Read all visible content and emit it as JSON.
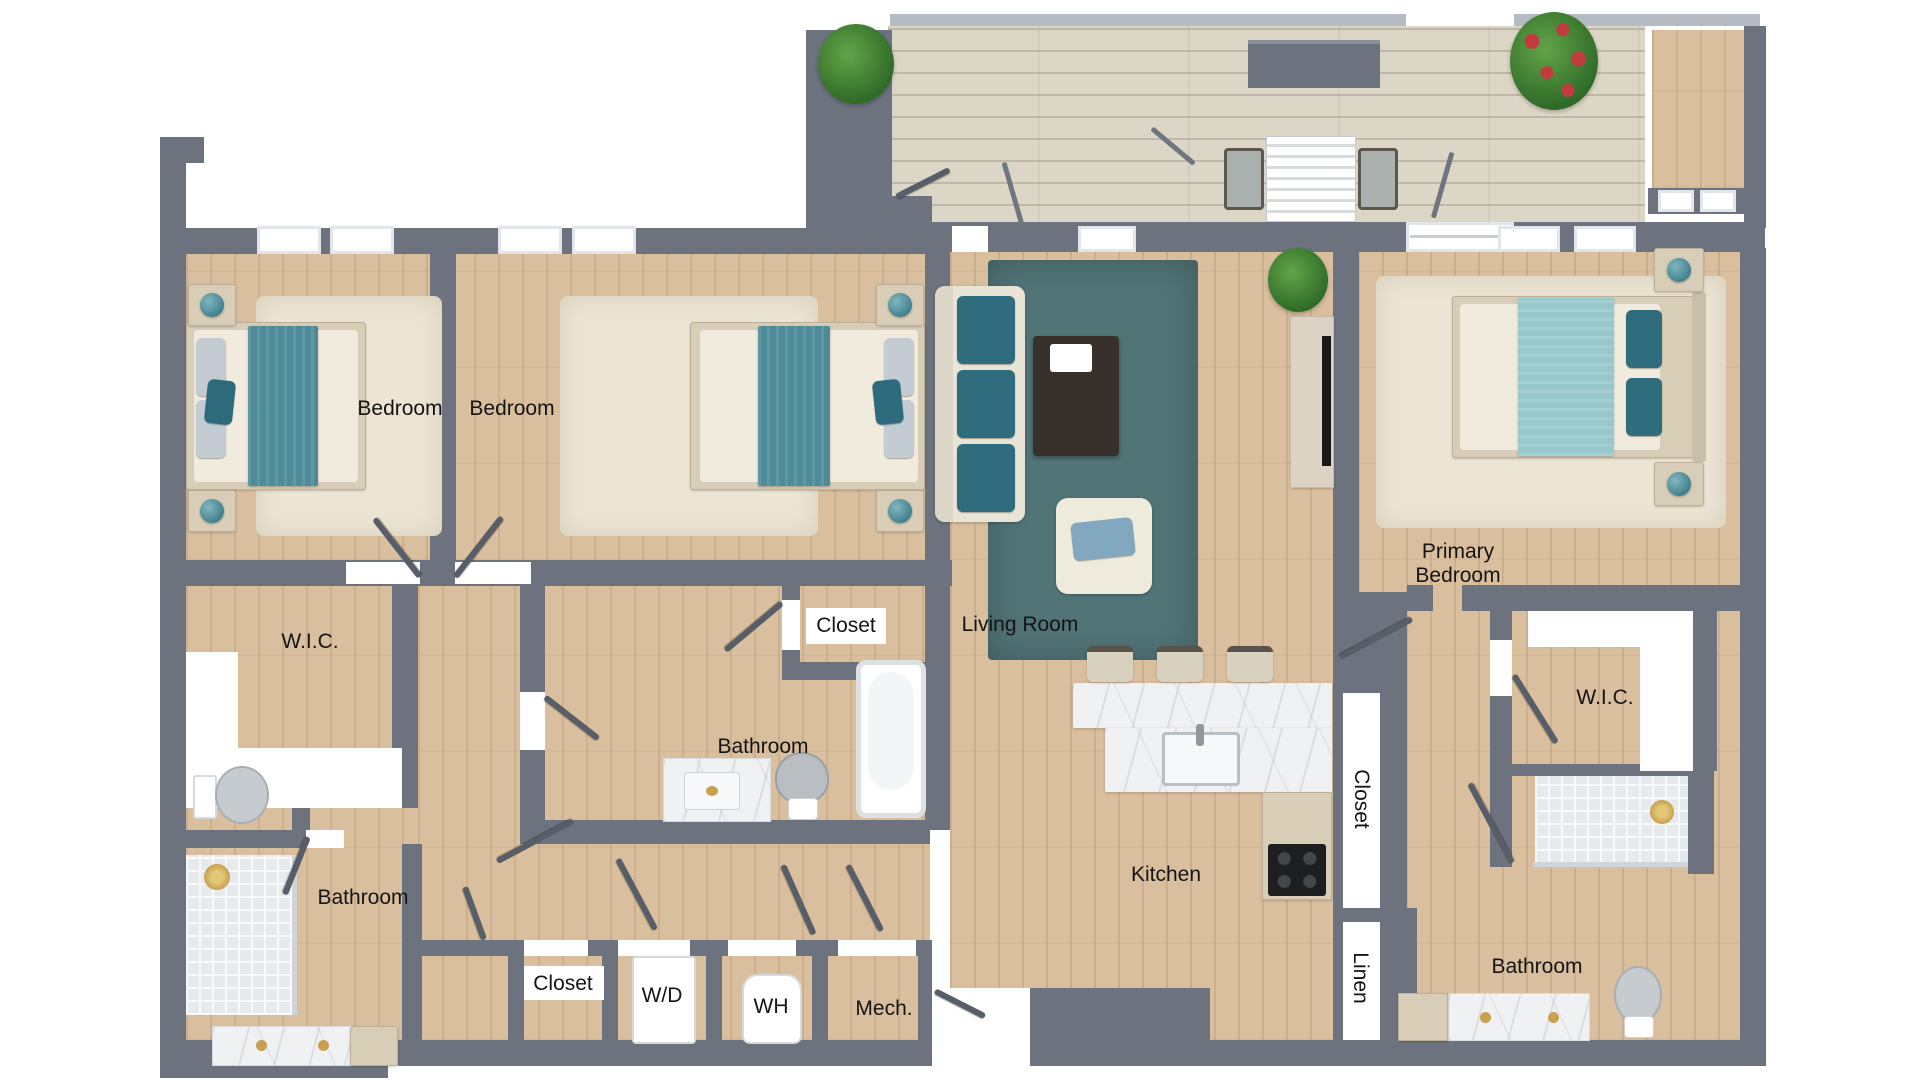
{
  "plan_title": "",
  "rooms": [
    {
      "id": "bedroom-1",
      "label": "Bedroom"
    },
    {
      "id": "bedroom-2",
      "label": "Bedroom"
    },
    {
      "id": "wic-left",
      "label": "W.I.C."
    },
    {
      "id": "closet-middle",
      "label": "Closet"
    },
    {
      "id": "living-room",
      "label": "Living Room"
    },
    {
      "id": "bathroom-middle",
      "label": "Bathroom"
    },
    {
      "id": "bathroom-left",
      "label": "Bathroom"
    },
    {
      "id": "closet-bottom-left",
      "label": "Closet"
    },
    {
      "id": "washer-dryer",
      "label": "W/D"
    },
    {
      "id": "water-heater",
      "label": "WH"
    },
    {
      "id": "mechanical",
      "label": "Mech."
    },
    {
      "id": "kitchen",
      "label": "Kitchen"
    },
    {
      "id": "closet-primary-hall",
      "label": "Closet"
    },
    {
      "id": "linen",
      "label": "Linen"
    },
    {
      "id": "primary-bedroom",
      "label": "Primary Bedroom"
    },
    {
      "id": "wic-right",
      "label": "W.I.C."
    },
    {
      "id": "bathroom-right",
      "label": "Bathroom"
    }
  ],
  "colors": {
    "wall": "#6d737e",
    "wood_floor": "#d9bf9e",
    "balcony_deck": "#dcd6c6",
    "accent_teal": "#2f6c7e",
    "lamp_teal": "#4f93a0",
    "primary_blanket_aqua": "#96c8cc",
    "living_rug": "#517476",
    "cream_rug": "#ece5d4",
    "marble": "#eff1f2",
    "gold_fixture": "#c8a04e",
    "door_leaf": "#585e68",
    "label_text": "#141414"
  }
}
